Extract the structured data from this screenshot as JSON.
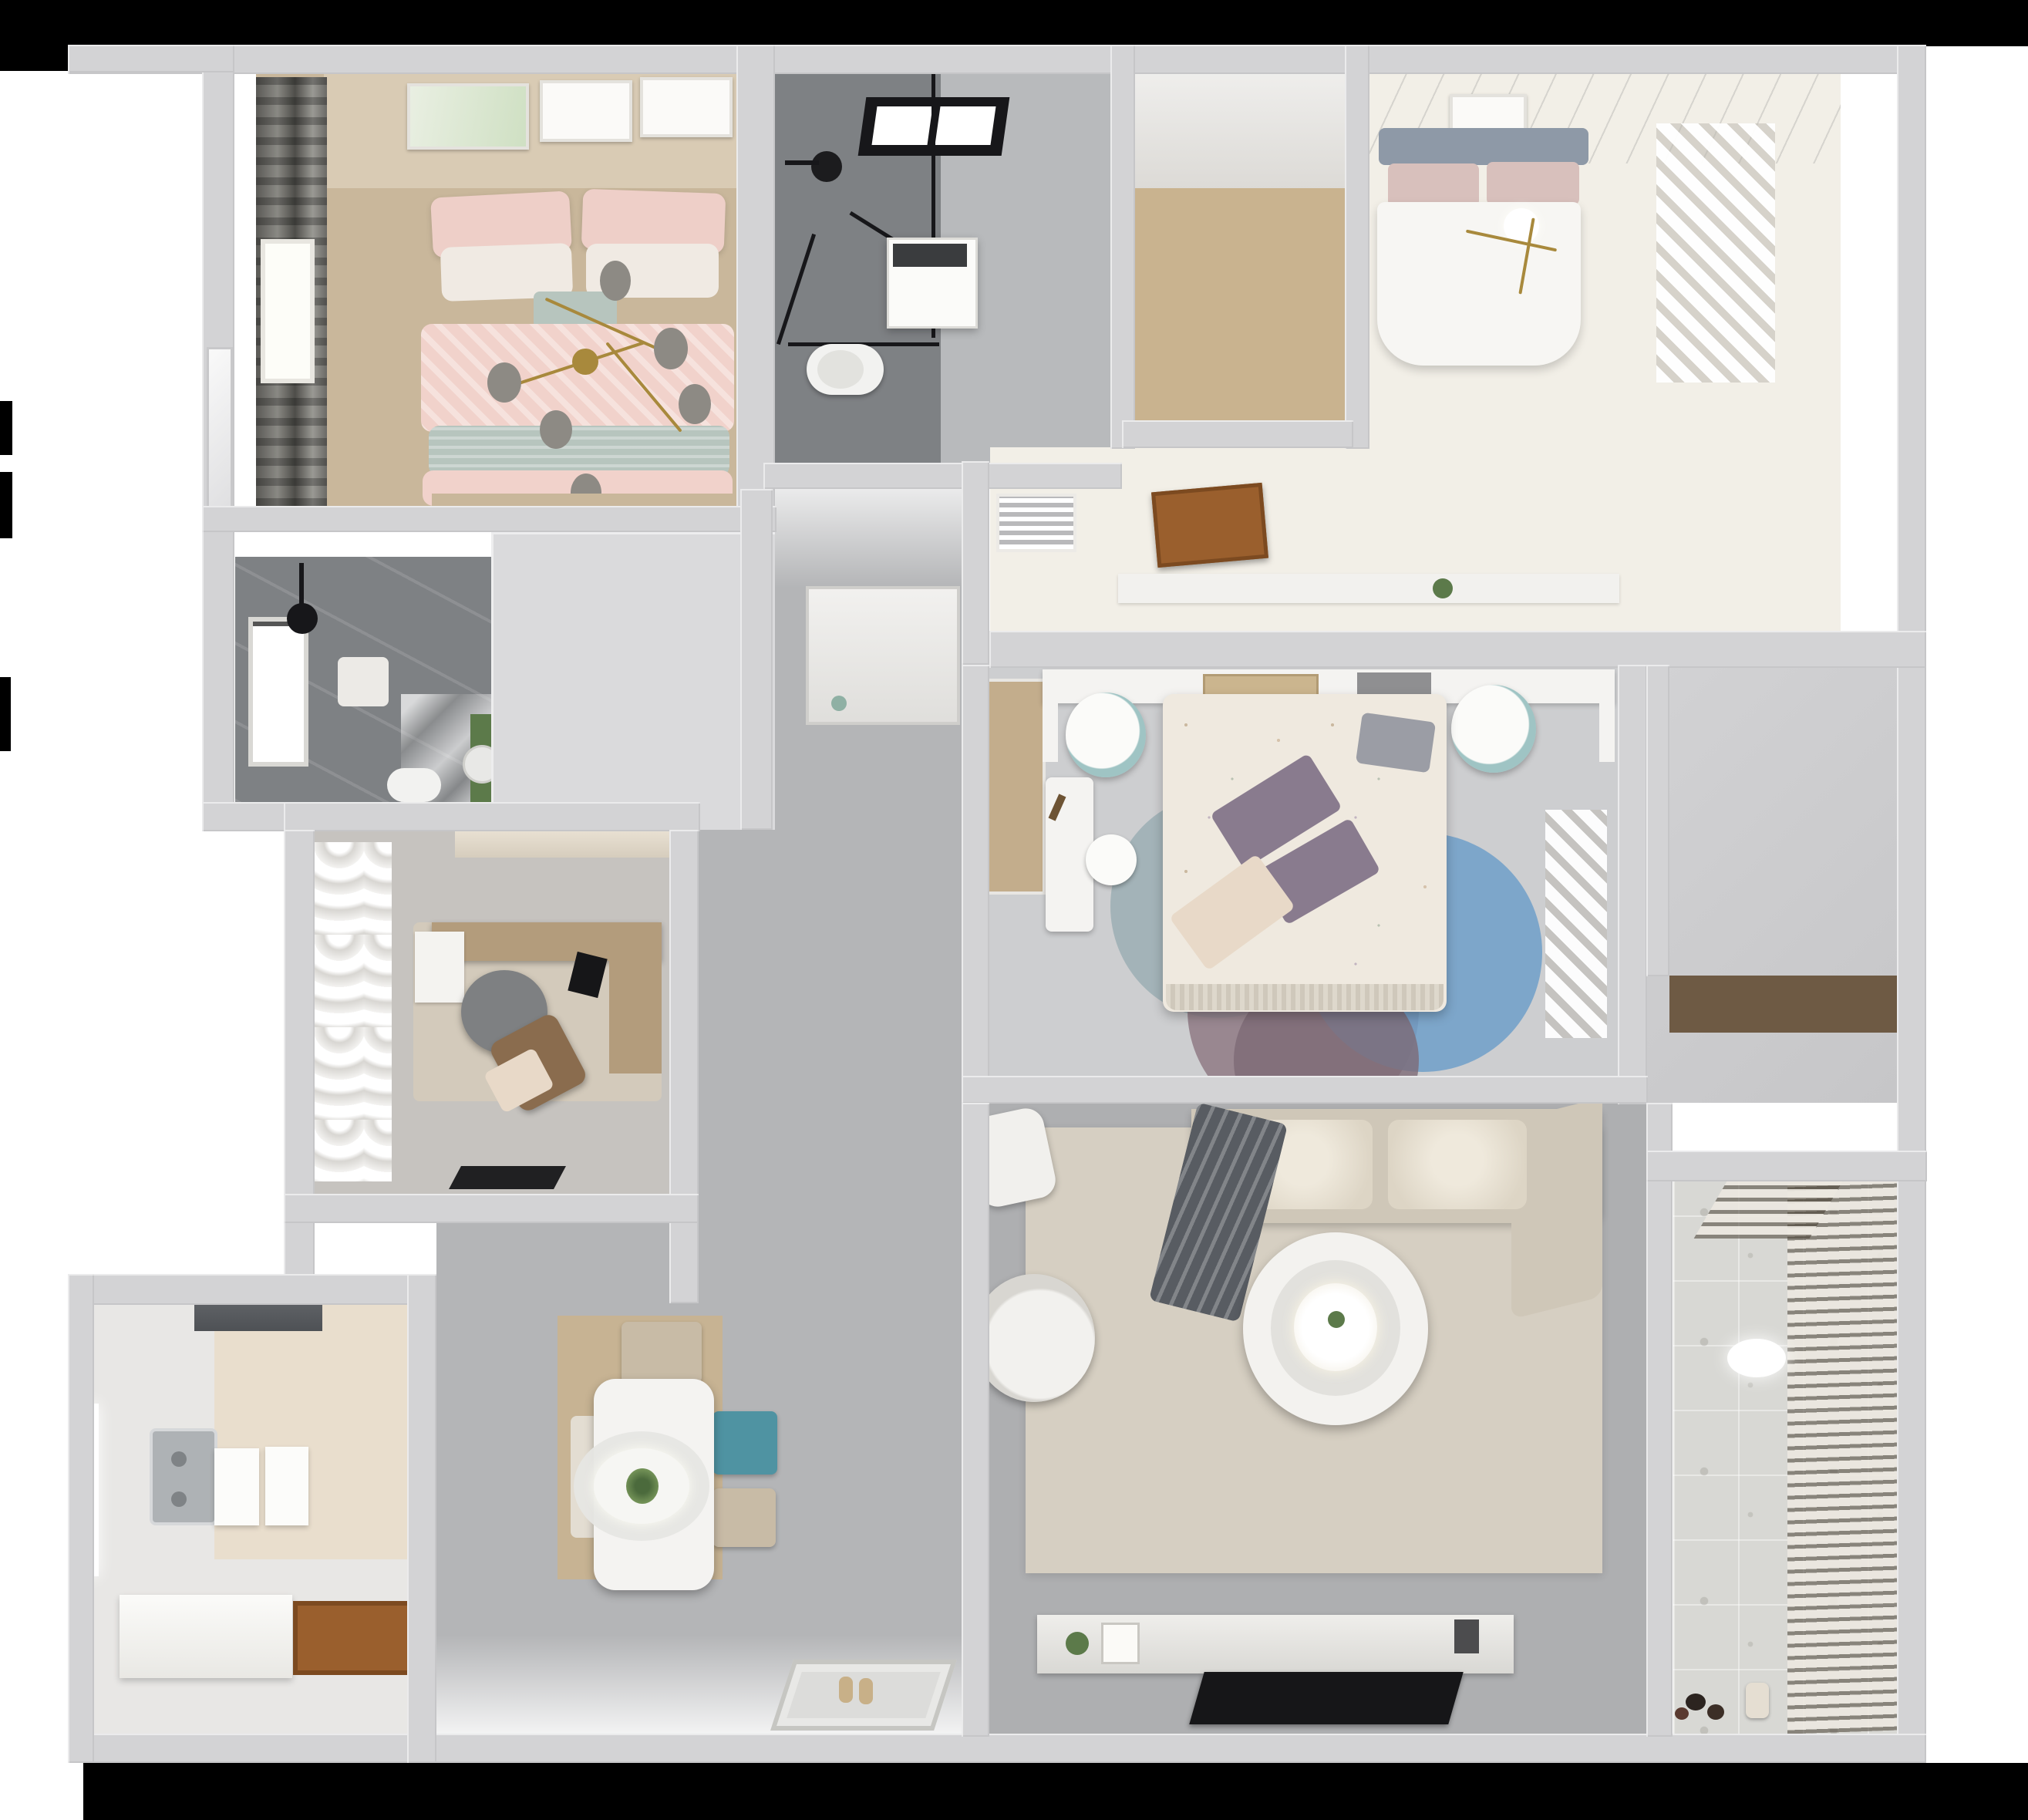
{
  "scene": {
    "type": "3d-floorplan-top-down-render",
    "description": "Photorealistic bird's-eye dollhouse render of a 3-bedroom apartment",
    "background": "#ffffff",
    "mask_color": "#000000",
    "wall_color": "#d3d3d5"
  },
  "palette": {
    "wall": "#d3d3d5",
    "wallblock": "#dadadc",
    "void_gray": "#cdcdcf",
    "corridor_tile": "#b4b5b7",
    "living_tile": "#aeafb1",
    "bedroom3_tile": "#cdced0",
    "study_tile": "#c6c3bf",
    "entry_tile": "#c9c9cb",
    "wood_light": "#c9b38f",
    "wood_closet": "#c3ad8c",
    "wood_dark": "#6e5a44",
    "door_brown": "#9a5f2d",
    "pink_bedroom_floor": "#c9b79b",
    "speckle_floor": "#f2efe7",
    "dark_bath_tile": "#7e8184",
    "bath_tile": "#b8babc",
    "hex_cream": "#e9decd",
    "kitchen_tile": "#e8e7e5",
    "balcony_tile": "#d8d8d4",
    "louver_tan": "#a79f92",
    "curtain_dark": "#6b6a66",
    "sofa_beige": "#cfc7b8",
    "sofa_cushion": "#e6dfd2",
    "throw_gray": "#585c62",
    "rug_living": "#d6cfc2",
    "rug_study": "#d3cabb",
    "rug_blue": "#6f9fc9",
    "rug_mauve": "#8f7a85",
    "rug_gray_teal": "#9fb0b5",
    "rug_mauve_dark": "#7d6a76",
    "duvet_pink": "#f1d2cb",
    "pillow_pink": "#eecfc8",
    "pillow_white": "#f0eae3",
    "sage_green": "#b7c5be",
    "headboard_tan": "#d9cbb4",
    "headboard_slat_blue": "#8e99a7",
    "blush_pillow": "#d8c0bc",
    "duvet_white": "#f7f6f3",
    "duvet_floral": "#efe9df",
    "pillow_purple": "#897b8e",
    "pillow_cream": "#e8d9c8",
    "teal_chair": "#4f93a2",
    "chair_beige": "#c8bba6",
    "desk_wood": "#b39c7c",
    "chair_dark_gray": "#7e8082",
    "chair_brown": "#8a6c4e",
    "table_white": "#f4f3f1",
    "plant_green": "#5c7a4a",
    "tv_black": "#161618",
    "steel": "#aeb2b5",
    "toilet_white": "#f2f2f0",
    "mat_black": "#202022",
    "gold": "#a8893c",
    "bulb_gray": "#8d8a84"
  },
  "rooms": [
    {
      "id": "bedroom-pink",
      "name": "Bedroom 1 (pink)",
      "floor": "wood",
      "items": [
        "double-bed-pink",
        "gold-branch-chandelier",
        "wall-art-frames",
        "window-curtain-dark",
        "bedside-rug"
      ]
    },
    {
      "id": "bathroom-top",
      "name": "Bathroom 1 (shower room)",
      "floor": "gray-tile",
      "items": [
        "glass-shower-enclosure",
        "black-skylight",
        "shower-head",
        "vanity-unit",
        "toilet"
      ]
    },
    {
      "id": "closet-room",
      "name": "Walk-in storage (wood floor)",
      "floor": "wood-planks",
      "items": []
    },
    {
      "id": "bedroom-master",
      "name": "Master bedroom",
      "floor": "floral-speckle",
      "items": [
        "double-bed-white",
        "slatted-headboard",
        "wall-art-frame",
        "gold-pendant",
        "sheer-curtain",
        "ac-vent",
        "open-wood-door"
      ]
    },
    {
      "id": "bathroom-left",
      "name": "Bathroom 2 (dark tiled)",
      "floor": "dark-tile-marble",
      "items": [
        "window",
        "shower-pendant",
        "shower-mat",
        "toilet",
        "green-accent",
        "mirror"
      ]
    },
    {
      "id": "study",
      "name": "Study / home office",
      "floor": "gray-tile",
      "items": [
        "curtain-wall",
        "distressed-rug",
        "l-desk",
        "desk-chair",
        "lounge-chair",
        "laptop",
        "doormat"
      ]
    },
    {
      "id": "bedroom-middle",
      "name": "Bedroom 2 (kids/guest)",
      "floor": "light-tile",
      "items": [
        "bed-floral-duvet",
        "purple-pillows",
        "headboard-shelf-bridge",
        "books",
        "pouf-left",
        "pouf-right",
        "white-desk",
        "desk-chair",
        "circle-rug",
        "wood-closet-strip",
        "sheer-curtain"
      ]
    },
    {
      "id": "living",
      "name": "Living room",
      "floor": "gray-tile",
      "items": [
        "sectional-sofa",
        "gray-throw",
        "armchair",
        "side-stool",
        "round-coffee-table",
        "area-rug",
        "tv-console",
        "tv-panel",
        "entry-doormat"
      ]
    },
    {
      "id": "kitchen",
      "name": "Kitchen",
      "floor": "hex-and-white-tile",
      "items": [
        "range-hood",
        "double-sink",
        "island-counters",
        "l-counter",
        "wood-door",
        "window"
      ]
    },
    {
      "id": "dining",
      "name": "Dining area",
      "floor": "gray-tile-wood-mat",
      "items": [
        "dining-table",
        "oval-pendant-lamp",
        "plant-centerpiece",
        "chair-beige-top",
        "chair-teal",
        "chair-beige-bottom",
        "bench"
      ]
    },
    {
      "id": "balcony",
      "name": "Balcony / laundry",
      "floor": "patterned-tile",
      "items": [
        "louver-blinds",
        "ceiling-light",
        "toys",
        "basket",
        "wood-shelf-band"
      ]
    },
    {
      "id": "corridor",
      "name": "Corridor / entry hall",
      "floor": "large-gray-tile",
      "items": [
        "hall-cabinet",
        "sill-plant"
      ]
    }
  ]
}
